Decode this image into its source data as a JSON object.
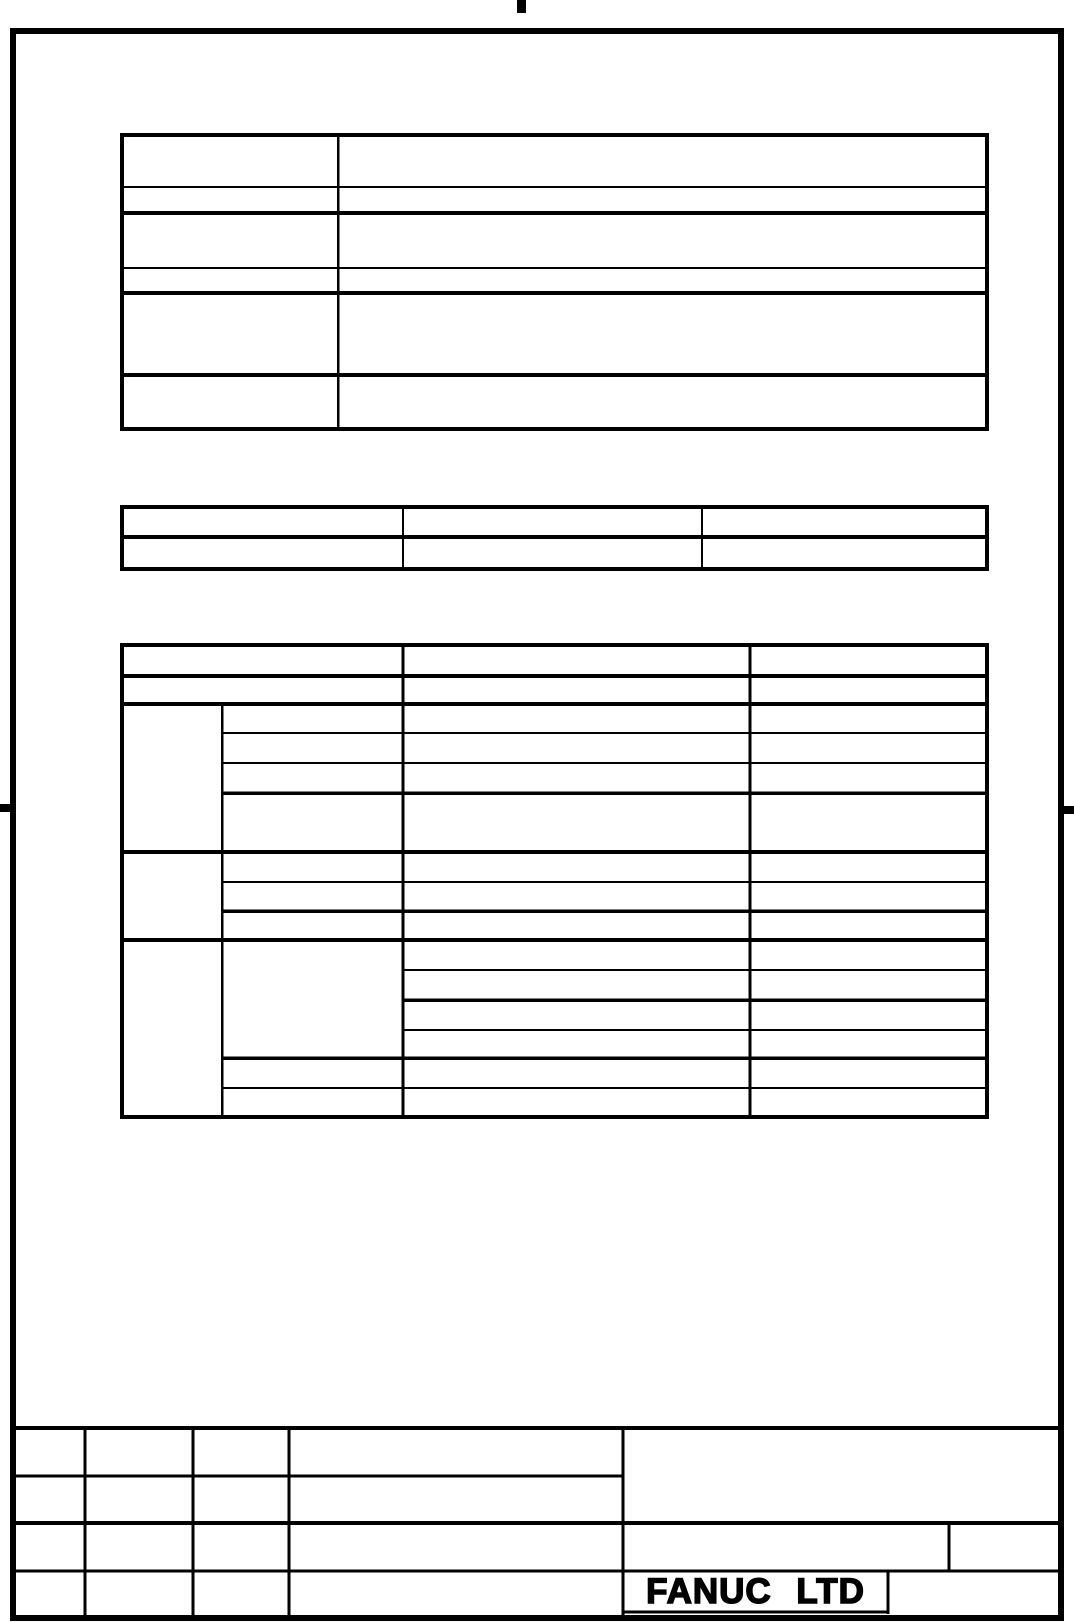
{
  "title_block": {
    "company_logo": "FANUC LTD"
  },
  "colors": {
    "ink": "#000000",
    "paper": "#ffffff"
  }
}
